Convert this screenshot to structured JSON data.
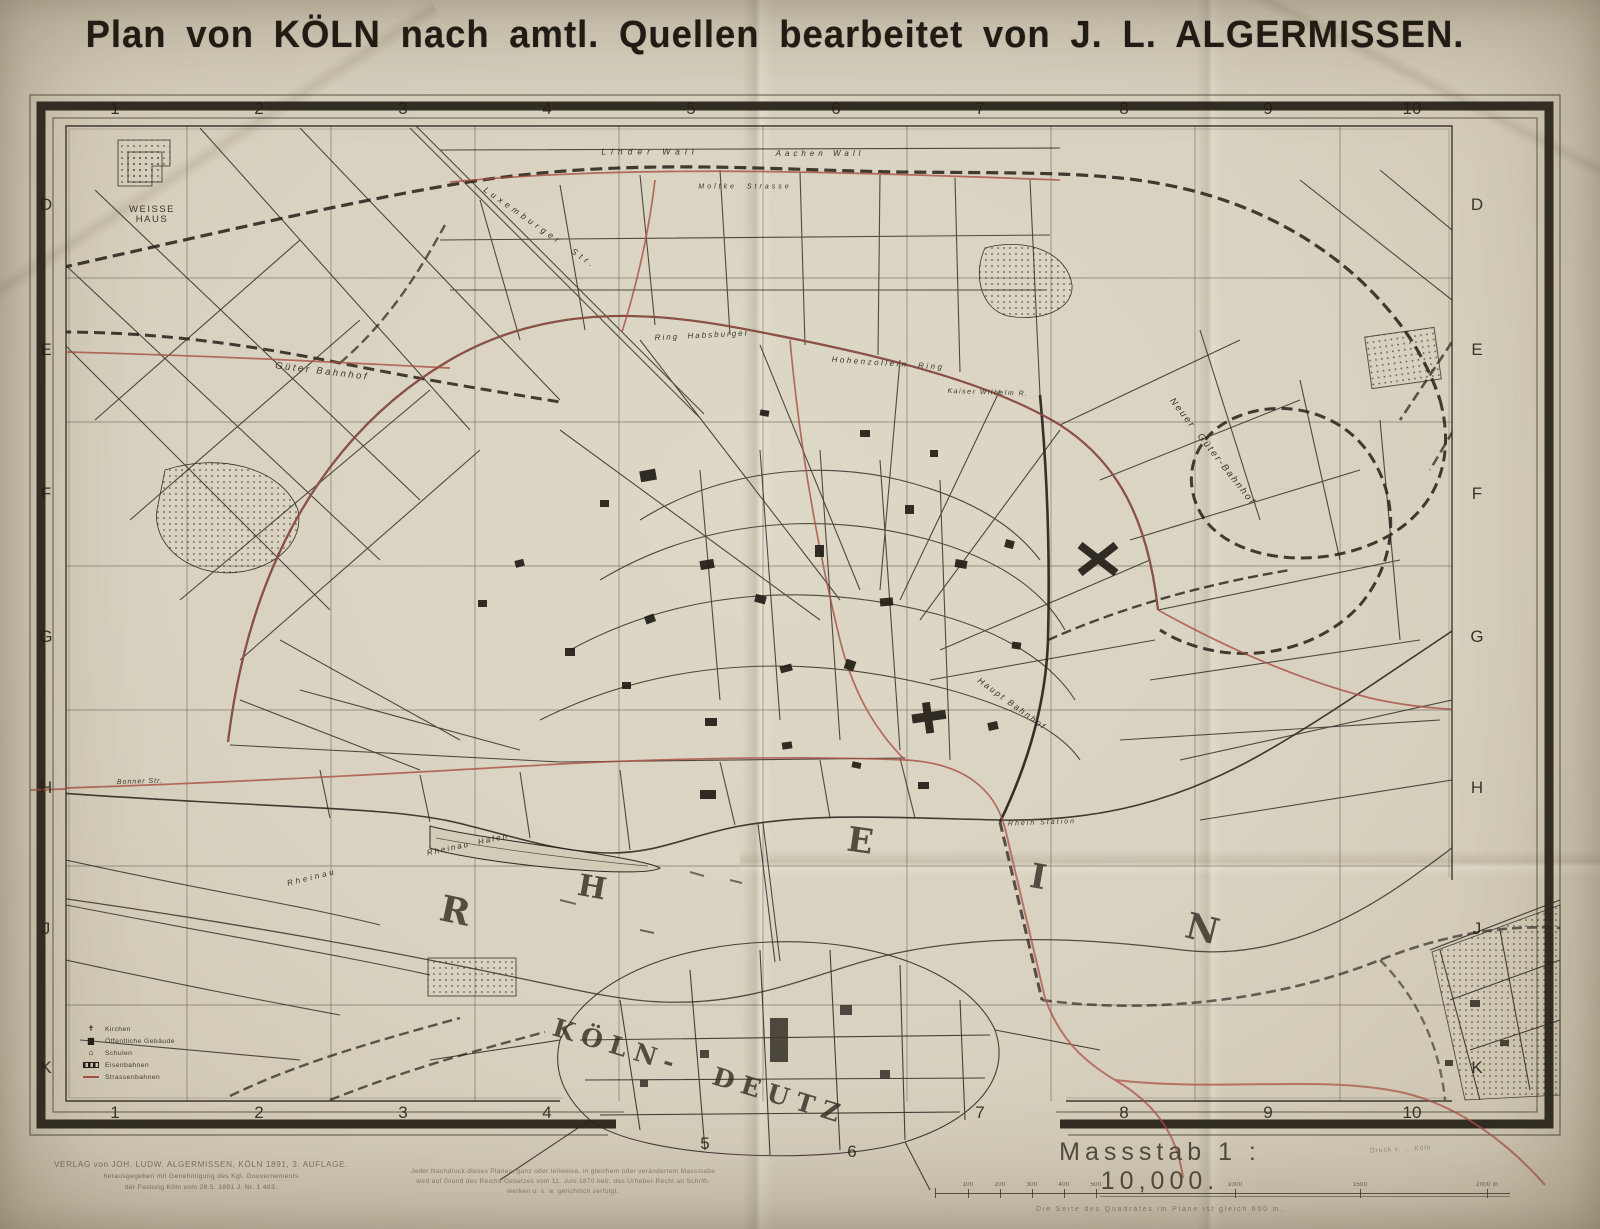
{
  "title": "Plan von KÖLN nach amtl. Quellen bearbeitet von J. L. ALGERMISSEN.",
  "grid": {
    "columns": [
      "1",
      "2",
      "3",
      "4",
      "5",
      "6",
      "7",
      "8",
      "9",
      "10"
    ],
    "rows": [
      "D",
      "E",
      "F",
      "G",
      "H",
      "J",
      "K"
    ]
  },
  "map": {
    "labels": [
      {
        "name": "weisse-haus",
        "text": "WEISSE\nHAUS",
        "x": 152,
        "y": 215,
        "size": 9.5,
        "ls": 1.5,
        "rot": 0
      },
      {
        "name": "luxemburger-str",
        "text": "Luxemburger  Str.",
        "x": 540,
        "y": 228,
        "size": 8.5,
        "ls": 4,
        "rot": 35,
        "cls": "it"
      },
      {
        "name": "linder-wall",
        "text": "Linder Wall",
        "x": 650,
        "y": 152,
        "size": 8.5,
        "ls": 5,
        "rot": 0,
        "cls": "it"
      },
      {
        "name": "aachen-wall",
        "text": "Aachen Wall",
        "x": 820,
        "y": 154,
        "size": 8,
        "ls": 4,
        "rot": 0,
        "cls": "it"
      },
      {
        "name": "moltke-strasse",
        "text": "Moltke  Strasse",
        "x": 745,
        "y": 187,
        "size": 7,
        "ls": 3,
        "rot": 0,
        "cls": "it"
      },
      {
        "name": "gueter-bahnhof",
        "text": "Güter Bahnhof",
        "x": 322,
        "y": 372,
        "size": 9.5,
        "ls": 2.5,
        "rot": 7,
        "cls": "it"
      },
      {
        "name": "neuer-gueter-bahnhof",
        "text": "Neuer  Güter-Bahnhof",
        "x": 1212,
        "y": 452,
        "size": 9.5,
        "ls": 2,
        "rot": 52,
        "cls": "it"
      },
      {
        "name": "habsburger-ring",
        "text": "Ring  Habsburger",
        "x": 702,
        "y": 336,
        "size": 8,
        "ls": 2,
        "rot": -3,
        "cls": "it"
      },
      {
        "name": "hohenzollern-ring",
        "text": "Hohenzollern  Ring",
        "x": 888,
        "y": 364,
        "size": 8,
        "ls": 2.5,
        "rot": 4,
        "cls": "it"
      },
      {
        "name": "kaiser-wilhelm-ring",
        "text": "Kaiser Wilhelm R.",
        "x": 988,
        "y": 393,
        "size": 7,
        "ls": 1.5,
        "rot": 2,
        "cls": "it"
      },
      {
        "name": "haupt-bahnhof",
        "text": "Haupt Bahnhof",
        "x": 1012,
        "y": 704,
        "size": 8.5,
        "ls": 2,
        "rot": 36,
        "cls": "it"
      },
      {
        "name": "rhein-station",
        "text": "Rhein Station",
        "x": 1042,
        "y": 823,
        "size": 7,
        "ls": 2,
        "rot": -2,
        "cls": "it"
      },
      {
        "name": "rheinau-hafen",
        "text": "Rheinau  Hafen",
        "x": 468,
        "y": 845,
        "size": 8,
        "ls": 2,
        "rot": -12,
        "cls": "it"
      },
      {
        "name": "rheinau",
        "text": "Rheinau",
        "x": 312,
        "y": 878,
        "size": 8,
        "ls": 3,
        "rot": -14,
        "cls": "it"
      },
      {
        "name": "bonner-str",
        "text": "Bonner Str.",
        "x": 140,
        "y": 782,
        "size": 7,
        "ls": 1,
        "rot": -2,
        "cls": "it"
      },
      {
        "name": "koeln-deutz",
        "text": "KÖLN-  DEUTZ",
        "x": 700,
        "y": 1072,
        "size": 25,
        "ls": 8,
        "rot": 17,
        "cls": "serif"
      },
      {
        "name": "rhein-letter-r",
        "text": "R",
        "x": 455,
        "y": 912,
        "size": 36,
        "ls": 0,
        "rot": 12,
        "cls": "serif"
      },
      {
        "name": "rhein-letter-h",
        "text": "H",
        "x": 592,
        "y": 888,
        "size": 30,
        "ls": 0,
        "rot": 10,
        "cls": "serif"
      },
      {
        "name": "rhein-letter-e",
        "text": "E",
        "x": 860,
        "y": 842,
        "size": 34,
        "ls": 0,
        "rot": 8,
        "cls": "serif"
      },
      {
        "name": "rhein-letter-i",
        "text": "I",
        "x": 1038,
        "y": 878,
        "size": 34,
        "ls": 0,
        "rot": 10,
        "cls": "serif"
      },
      {
        "name": "rhein-letter-n",
        "text": "N",
        "x": 1202,
        "y": 930,
        "size": 36,
        "ls": 0,
        "rot": 14,
        "cls": "serif"
      }
    ]
  },
  "legend": {
    "items": [
      {
        "icon": "church-icon",
        "label": "Kirchen"
      },
      {
        "icon": "public-building-icon",
        "label": "Öffentliche Gebäude"
      },
      {
        "icon": "school-icon",
        "label": "Schulen"
      },
      {
        "icon": "railway-line-icon",
        "label": "Eisenbahnen"
      },
      {
        "icon": "tram-line-icon",
        "label": "Strassenbahnen"
      }
    ]
  },
  "scale": {
    "title": "Massstab 1 : 10,000.",
    "printer_note": "Druck v. … Köln",
    "ticks": [
      "100",
      "200",
      "300",
      "400",
      "500",
      "1000",
      "1500",
      "2000 m"
    ],
    "caption": "Die Seite des Quadrates im Plane ist gleich 600 m."
  },
  "imprint": {
    "publisher_line1": "VERLAG von JOH. LUDW. ALGERMISSEN, KÖLN 1891, 3. AUFLAGE.",
    "publisher_line2": "herausgegeben mit Genehmigung des Kgl. Gouvernements",
    "publisher_line3": "der Festung Köln vom 28.5. 1891 J. Nr. 1 483.",
    "copyright_line1": "Jeder Nachdruck dieses Planes, ganz oder teilweise, in gleichem oder verändertem Massstabe",
    "copyright_line2": "wird auf Grund des Reichs-Gesetzes vom 11. Juni 1870 betr. das Urheber-Recht an Schrift-",
    "copyright_line3": "werken u. s. w. gerichtlich verfolgt."
  },
  "colors": {
    "paper": "#d8d1bf",
    "ink": "#241f17",
    "tram_red": "#a94f43"
  }
}
